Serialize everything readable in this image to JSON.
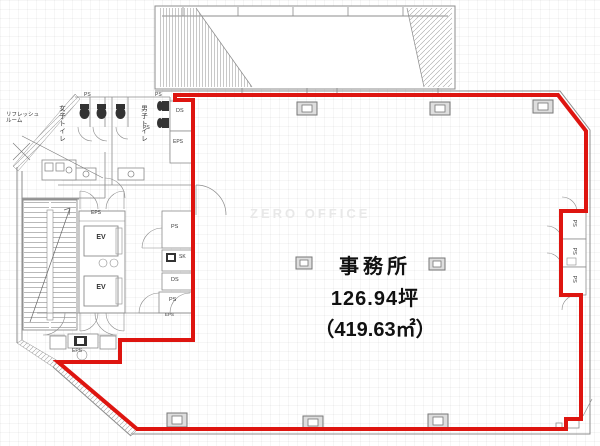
{
  "plan": {
    "watermark": "ZERO OFFICE",
    "unit": {
      "name": "事務所",
      "area_tsubo": "126.94坪",
      "area_sqm": "（419.63㎡）"
    }
  },
  "labels": {
    "refresh_room_line1": "リフレッシュ",
    "refresh_room_line2": "ルーム",
    "womens_toilet": "女子トイレ",
    "mens_toilet": "男子トイレ",
    "ev": "EV",
    "eps": "EPS",
    "ps": "PS",
    "ds": "DS",
    "sk": "SK"
  },
  "colors": {
    "boundary_red": "#de1510",
    "wall_gray": "#8c8c8c",
    "watermark_gray": "#e8e8e8"
  }
}
